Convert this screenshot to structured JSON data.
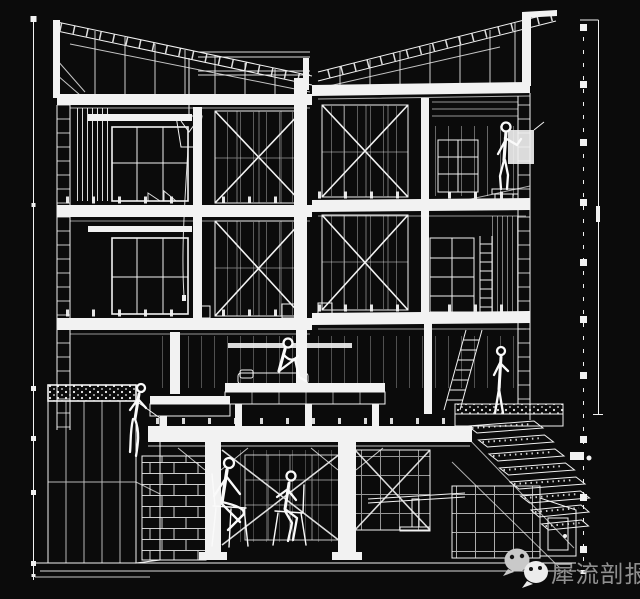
{
  "canvas": {
    "bg": "#0b0b0b",
    "line_color": "#f2f2f2"
  },
  "watermark": {
    "text": "犀流剖报",
    "text_color": "#8f8f8f",
    "icon": "wechat-icon",
    "icon_count": 2,
    "icon_color_back": "#c9c9c9",
    "icon_color_front": "#ececec"
  },
  "drawing": {
    "kind": "architectural sectional perspective, white wireframe line art on black",
    "levels": [
      "roof",
      "level-3",
      "level-2",
      "level-1",
      "basement"
    ],
    "figures": [
      "person-on-stool-level-3",
      "person-seated-on-platform-level-1",
      "woman-standing-level-1",
      "woman-seated-on-planter",
      "man-seated-cross-legged-basement",
      "person-seated-on-chair-basement"
    ],
    "features": [
      "sloped-rafter-bands",
      "x-bracing-panels",
      "window-bays",
      "hanging-bucket-lamp",
      "shelving-units",
      "ladder",
      "sleeping-platform",
      "planter-box",
      "gravel-strip",
      "garden-stair-steps",
      "brick-retaining-wall",
      "left-reference-line",
      "right-dashed-reference-line",
      "right-dimension-line"
    ]
  }
}
